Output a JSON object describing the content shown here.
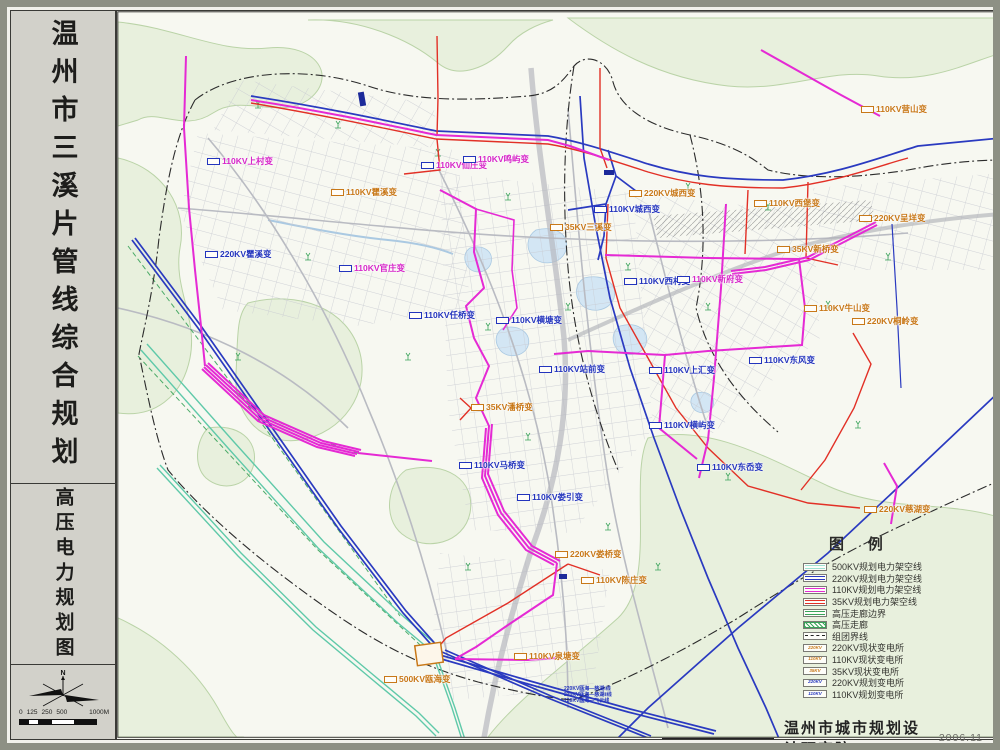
{
  "sidebar": {
    "title": "温州市三溪片管线综合规划",
    "subtitle": "高压电力规划图",
    "compass": "N",
    "scale_labels": [
      "0",
      "125",
      "250",
      "500",
      "1000M"
    ]
  },
  "legend": {
    "title": "图 例",
    "items": [
      {
        "label": "500KV规划电力架空线",
        "type": "line",
        "color": "#9fe2d2"
      },
      {
        "label": "220KV规划电力架空线",
        "type": "line",
        "color": "#2a3ac0"
      },
      {
        "label": "110KV规划电力架空线",
        "type": "line",
        "color": "#e52ad4"
      },
      {
        "label": "35KV规划电力架空线",
        "type": "line",
        "color": "#e23026"
      },
      {
        "label": "高压走廊边界",
        "type": "line",
        "color": "#3aa35a"
      },
      {
        "label": "高压走廊",
        "type": "hatch",
        "color": "#3aa35a"
      },
      {
        "label": "组团界线",
        "type": "dashdot",
        "color": "#222222"
      },
      {
        "label": "220KV现状变电所",
        "type": "station",
        "text": "220KV",
        "color": "#c87818"
      },
      {
        "label": "110KV现状变电所",
        "type": "station",
        "text": "110KV",
        "color": "#c87818"
      },
      {
        "label": "35KV现状变电所",
        "type": "station",
        "text": "35KV",
        "color": "#c87818"
      },
      {
        "label": "220KV规划变电所",
        "type": "station",
        "text": "220KV",
        "color": "#2334bd"
      },
      {
        "label": "110KV规划变电所",
        "type": "station",
        "text": "110KV",
        "color": "#2334bd"
      }
    ]
  },
  "map_labels": [
    {
      "text": "110KV上村变",
      "x": 90,
      "y": 146,
      "c": "magenta"
    },
    {
      "text": "110KV仙庄变",
      "x": 304,
      "y": 150,
      "c": "magenta"
    },
    {
      "text": "110KV瞿溪变",
      "x": 214,
      "y": 177,
      "c": "orange"
    },
    {
      "text": "220KV瞿溪变",
      "x": 88,
      "y": 239,
      "c": "blue"
    },
    {
      "text": "110KV官庄变",
      "x": 222,
      "y": 253,
      "c": "magenta"
    },
    {
      "text": "110KV鸣屿变",
      "x": 346,
      "y": 144,
      "c": "magenta"
    },
    {
      "text": "220KV城西变",
      "x": 512,
      "y": 178,
      "c": "orange"
    },
    {
      "text": "110KV城西变",
      "x": 477,
      "y": 194,
      "c": "blue"
    },
    {
      "text": "35KV三溪变",
      "x": 433,
      "y": 212,
      "c": "orange"
    },
    {
      "text": "110KV西村变",
      "x": 507,
      "y": 266,
      "c": "blue"
    },
    {
      "text": "110KV新府变",
      "x": 560,
      "y": 264,
      "c": "magenta"
    },
    {
      "text": "110KV营山变",
      "x": 744,
      "y": 94,
      "c": "orange"
    },
    {
      "text": "110KV西堡变",
      "x": 637,
      "y": 188,
      "c": "orange"
    },
    {
      "text": "220KV呈垟变",
      "x": 742,
      "y": 203,
      "c": "orange"
    },
    {
      "text": "35KV新桥变",
      "x": 660,
      "y": 234,
      "c": "orange"
    },
    {
      "text": "110KV牛山变",
      "x": 687,
      "y": 293,
      "c": "orange"
    },
    {
      "text": "220KV桐岭变",
      "x": 735,
      "y": 306,
      "c": "orange"
    },
    {
      "text": "110KV任桥变",
      "x": 292,
      "y": 300,
      "c": "blue"
    },
    {
      "text": "110KV横塘变",
      "x": 379,
      "y": 305,
      "c": "blue"
    },
    {
      "text": "110KV站前变",
      "x": 422,
      "y": 354,
      "c": "blue"
    },
    {
      "text": "110KV上汇变",
      "x": 532,
      "y": 355,
      "c": "blue"
    },
    {
      "text": "110KV东风变",
      "x": 632,
      "y": 345,
      "c": "blue"
    },
    {
      "text": "35KV潘桥变",
      "x": 354,
      "y": 392,
      "c": "orange"
    },
    {
      "text": "110KV横屿变",
      "x": 532,
      "y": 410,
      "c": "blue"
    },
    {
      "text": "110KV东岙变",
      "x": 580,
      "y": 452,
      "c": "blue"
    },
    {
      "text": "110KV马桥变",
      "x": 342,
      "y": 450,
      "c": "blue"
    },
    {
      "text": "110KV娄引变",
      "x": 400,
      "y": 482,
      "c": "blue"
    },
    {
      "text": "220KV娄桥变",
      "x": 438,
      "y": 539,
      "c": "orange"
    },
    {
      "text": "110KV陈庄变",
      "x": 464,
      "y": 565,
      "c": "orange"
    },
    {
      "text": "110KV泉塘变",
      "x": 397,
      "y": 641,
      "c": "orange"
    },
    {
      "text": "500KV瓯海变",
      "x": 267,
      "y": 664,
      "c": "orange"
    },
    {
      "text": "220KV慈湖变",
      "x": 747,
      "y": 494,
      "c": "orange"
    }
  ],
  "annotations": [
    "220KV瓯海—慈湖Ⅰ线",
    "220KV瓯海—慈湖Ⅱ线",
    "220KV瓯海—飞云线"
  ],
  "footer": {
    "org": "温州市城市规划设计研究院",
    "date": "2006.11"
  },
  "colors": {
    "line_500kv": "#5fc9a9",
    "line_220kv": "#2a3ac0",
    "line_110kv": "#e52ad4",
    "line_35kv": "#e23026",
    "corridor_green": "#3aa35a",
    "boundary": "#2b2b2b",
    "label_existing": "#c87818",
    "label_planned": "#2334bd",
    "label_110_planned": "#d626c8"
  }
}
